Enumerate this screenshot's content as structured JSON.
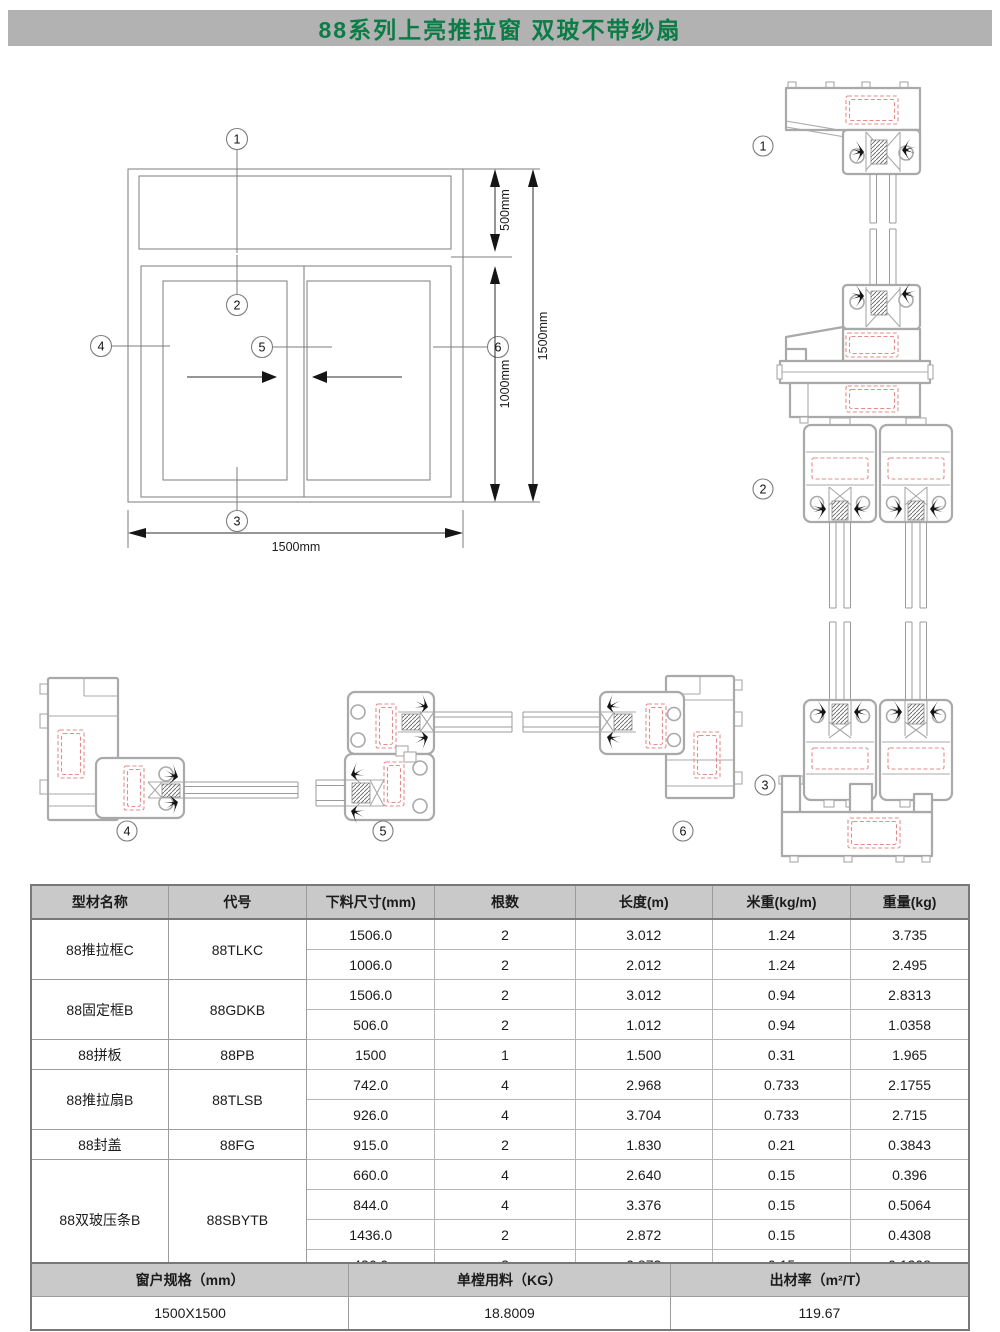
{
  "title": "88系列上亮推拉窗 双玻不带纱扇",
  "diagram": {
    "dims": {
      "upper": "500mm",
      "lower": "1000mm",
      "total_height": "1500mm",
      "total_width": "1500mm"
    },
    "markers": {
      "m1": "1",
      "m2": "2",
      "m3": "3",
      "m4": "4",
      "m5": "5",
      "m6": "6"
    }
  },
  "table": {
    "headers": [
      "型材名称",
      "代号",
      "下料尺寸(mm)",
      "根数",
      "长度(m)",
      "米重(kg/m)",
      "重量(kg)"
    ],
    "groups": [
      {
        "name": "88推拉框C",
        "code": "88TLKC",
        "rows": [
          [
            "1506.0",
            "2",
            "3.012",
            "1.24",
            "3.735"
          ],
          [
            "1006.0",
            "2",
            "2.012",
            "1.24",
            "2.495"
          ]
        ]
      },
      {
        "name": "88固定框B",
        "code": "88GDKB",
        "rows": [
          [
            "1506.0",
            "2",
            "3.012",
            "0.94",
            "2.8313"
          ],
          [
            "506.0",
            "2",
            "1.012",
            "0.94",
            "1.0358"
          ]
        ]
      },
      {
        "name": "88拼板",
        "code": "88PB",
        "rows": [
          [
            "1500",
            "1",
            "1.500",
            "0.31",
            "1.965"
          ]
        ]
      },
      {
        "name": "88推拉扇B",
        "code": "88TLSB",
        "rows": [
          [
            "742.0",
            "4",
            "2.968",
            "0.733",
            "2.1755"
          ],
          [
            "926.0",
            "4",
            "3.704",
            "0.733",
            "2.715"
          ]
        ]
      },
      {
        "name": "88封盖",
        "code": "88FG",
        "rows": [
          [
            "915.0",
            "2",
            "1.830",
            "0.21",
            "0.3843"
          ]
        ]
      },
      {
        "name": "88双玻压条B",
        "code": "88SBYTB",
        "rows": [
          [
            "660.0",
            "4",
            "2.640",
            "0.15",
            "0.396"
          ],
          [
            "844.0",
            "4",
            "3.376",
            "0.15",
            "0.5064"
          ],
          [
            "1436.0",
            "2",
            "2.872",
            "0.15",
            "0.4308"
          ],
          [
            "436.0",
            "2",
            "0.872",
            "0.15",
            "0.1308"
          ]
        ]
      }
    ]
  },
  "summary": {
    "headers": [
      "窗户规格（mm）",
      "单樘用料（KG）",
      "出材率（m²/T）"
    ],
    "values": [
      "1500X1500",
      "18.8009",
      "119.67"
    ]
  },
  "colors": {
    "band": "#b2b2b2",
    "title_green": "#0a7c46",
    "table_header": "#c9c9c9",
    "profile_gray": "#a9a9a9",
    "chamber_red": "#e58b8b"
  }
}
